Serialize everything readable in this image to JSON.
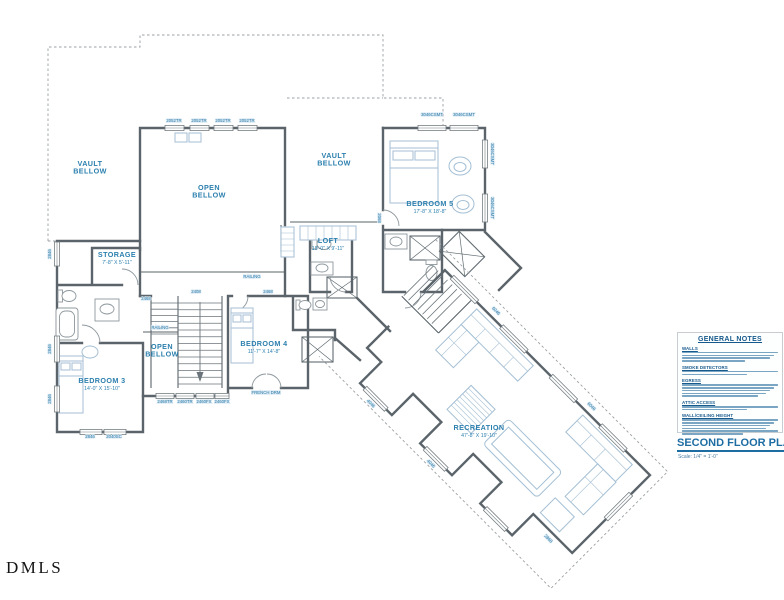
{
  "watermark": "DMLS",
  "plan_title": {
    "label": "SECOND FLOOR PLAN",
    "scale": "Scale: 1/4\" = 1'-0\""
  },
  "colors": {
    "wall": "#5a646a",
    "room_label": "#2b7fae",
    "code_label": "#2878a8",
    "notes_heading": "#16598c",
    "furniture": "#a4bfd4",
    "dashed": "#9aa0a4"
  },
  "notes": {
    "title": "GENERAL NOTES",
    "sections": [
      {
        "heading": "WALLS",
        "lines": 4
      },
      {
        "heading": "SMOKE DETECTORS",
        "lines": 2
      },
      {
        "heading": "EGRESS",
        "lines": 5
      },
      {
        "heading": "ATTIC ACCESS",
        "lines": 2
      },
      {
        "heading": "WALL/CEILING HEIGHT",
        "lines": 6
      }
    ]
  },
  "rooms": [
    {
      "name": "vault-bellow-nw",
      "label": "VAULT\nBELLOW",
      "x": 90,
      "y": 166
    },
    {
      "name": "open-bellow-main",
      "label": "OPEN\nBELLOW",
      "x": 209,
      "y": 190
    },
    {
      "name": "vault-bellow-center",
      "label": "VAULT\nBELLOW",
      "x": 334,
      "y": 158
    },
    {
      "name": "bedroom-5",
      "label": "BEDROOM 5",
      "dims": "17'-8\" X 18'-8\"",
      "x": 430,
      "y": 206
    },
    {
      "name": "storage",
      "label": "STORAGE",
      "dims": "7'-8\" X 5'-11\"",
      "x": 117,
      "y": 257
    },
    {
      "name": "loft",
      "label": "LOFT",
      "dims": "18'-0\" X 9'-11\"",
      "x": 328,
      "y": 243
    },
    {
      "name": "open-bellow-stair",
      "label": "OPEN\nBELLOW",
      "x": 162,
      "y": 349
    },
    {
      "name": "bedroom-4",
      "label": "BEDROOM 4",
      "dims": "11'-7\" X 14'-8\"",
      "x": 264,
      "y": 346
    },
    {
      "name": "bedroom-3",
      "label": "BEDROOM 3",
      "dims": "14'-0\" X 15'-10\"",
      "x": 102,
      "y": 383
    },
    {
      "name": "recreation",
      "label": "RECREATION",
      "dims": "47'-8\" X 19'-10\"",
      "x": 479,
      "y": 430
    }
  ],
  "annotations": [
    {
      "text": "2052TR",
      "x": 174,
      "y": 122
    },
    {
      "text": "2052TR",
      "x": 199,
      "y": 122
    },
    {
      "text": "2052TR",
      "x": 223,
      "y": 122
    },
    {
      "text": "2052TR",
      "x": 247,
      "y": 122
    },
    {
      "text": "3046CSMT",
      "x": 432,
      "y": 116
    },
    {
      "text": "3046CSMT",
      "x": 464,
      "y": 116
    },
    {
      "text": "3046CSMT",
      "x": 491,
      "y": 154,
      "r": 90
    },
    {
      "text": "3046CSMT",
      "x": 491,
      "y": 208,
      "r": 90
    },
    {
      "text": "2846",
      "x": 51,
      "y": 254,
      "r": -90
    },
    {
      "text": "2846",
      "x": 51,
      "y": 349,
      "r": -90
    },
    {
      "text": "2846",
      "x": 51,
      "y": 399,
      "r": -90
    },
    {
      "text": "RAILING",
      "x": 252,
      "y": 278
    },
    {
      "text": "RAILING",
      "x": 160,
      "y": 329
    },
    {
      "text": "2468",
      "x": 146,
      "y": 300
    },
    {
      "text": "2408",
      "x": 196,
      "y": 293
    },
    {
      "text": "2468",
      "x": 268,
      "y": 293
    },
    {
      "text": "2068",
      "x": 378,
      "y": 218,
      "r": 90
    },
    {
      "text": "2468TR",
      "x": 165,
      "y": 403
    },
    {
      "text": "2460TR",
      "x": 185,
      "y": 403
    },
    {
      "text": "2460FX",
      "x": 204,
      "y": 403
    },
    {
      "text": "2460FX",
      "x": 222,
      "y": 403
    },
    {
      "text": "FRENCH DRM",
      "x": 266,
      "y": 394
    },
    {
      "text": "2846",
      "x": 90,
      "y": 438
    },
    {
      "text": "2040SC",
      "x": 114,
      "y": 438
    },
    {
      "text": "6046",
      "x": 430,
      "y": 347,
      "g": "wing"
    },
    {
      "text": "6046",
      "x": 565,
      "y": 347,
      "g": "wing"
    },
    {
      "text": "4046",
      "x": 407,
      "y": 501,
      "g": "wing"
    },
    {
      "text": "4046",
      "x": 492,
      "y": 501,
      "g": "wing"
    },
    {
      "text": "2868",
      "x": 628,
      "y": 471,
      "g": "wing"
    }
  ]
}
